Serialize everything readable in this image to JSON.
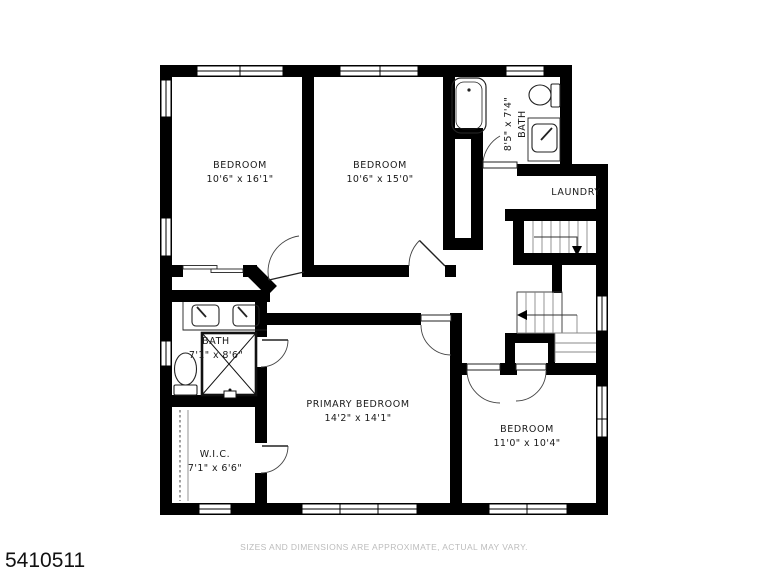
{
  "footer": {
    "listing_id": "5410511",
    "disclaimer": "SIZES AND DIMENSIONS ARE APPROXIMATE, ACTUAL MAY VARY."
  },
  "plan": {
    "colors": {
      "wall": "#000000",
      "thin_line": "#444444",
      "tread_line": "#888888",
      "label_text": "#1a1a1a",
      "disclaimer_text": "#bcbcbc",
      "background": "#ffffff"
    },
    "rooms": [
      {
        "name": "BEDROOM",
        "dims": "10'6\" x 16'1\""
      },
      {
        "name": "BEDROOM",
        "dims": "10'6\" x 15'0\""
      },
      {
        "name": "BATH",
        "dims": "8'5\" x 7'4\""
      },
      {
        "name": "LAUNDRY",
        "dims": ""
      },
      {
        "name": "BATH",
        "dims": "7'1\" x 8'6\""
      },
      {
        "name": "W.I.C.",
        "dims": "7'1\" x 6'6\""
      },
      {
        "name": "PRIMARY BEDROOM",
        "dims": "14'2\" x 14'1\""
      },
      {
        "name": "BEDROOM",
        "dims": "11'0\" x 10'4\""
      }
    ],
    "fixtures": [
      "bathtub",
      "toilet",
      "vanity-sink",
      "double-vanity-sink",
      "shower-stall",
      "toilet",
      "staircase-upper",
      "staircase-lower",
      "closet-rod",
      "sliding-closet-doors"
    ]
  }
}
